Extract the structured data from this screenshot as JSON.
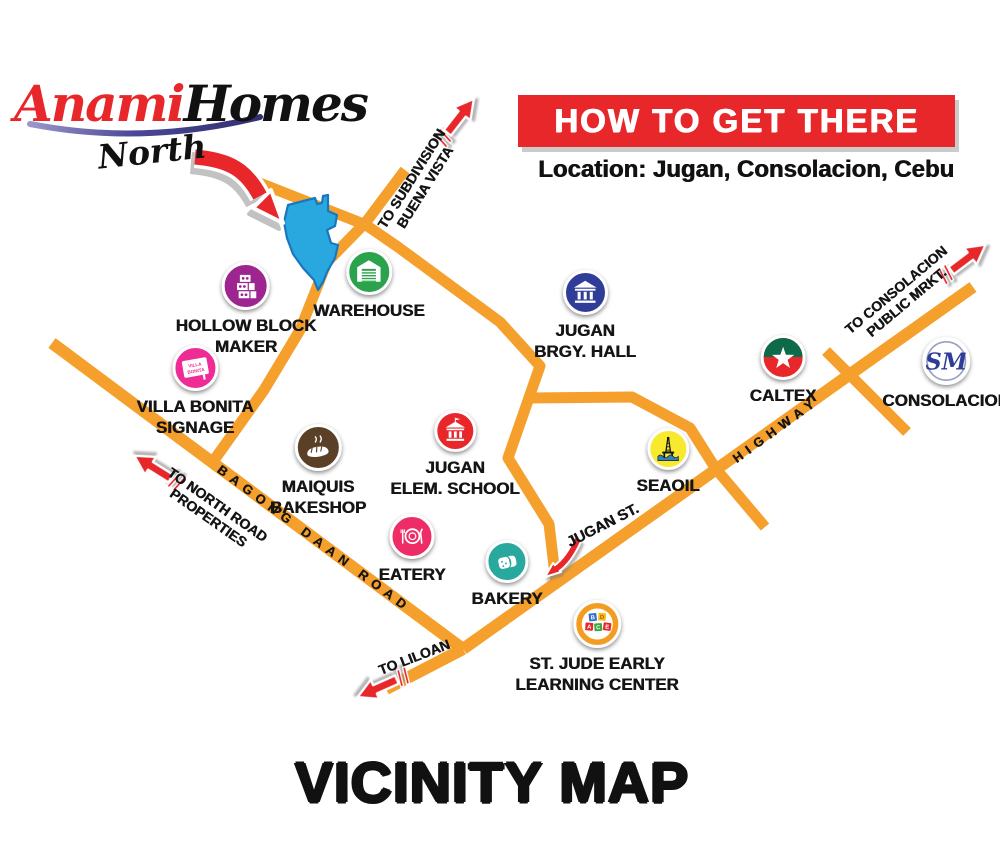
{
  "logo": {
    "brand_red": "Anami",
    "brand_black": "Homes",
    "subtitle": "North"
  },
  "header": {
    "banner": "HOW TO GET THERE",
    "location": "Location: Jugan, Consolacion, Cebu"
  },
  "footer_title": "VICINITY MAP",
  "colors": {
    "road": "#F5A02C",
    "red": "#E8272B",
    "logo_red": "#E8272B",
    "swoosh_purple": "#4B4798",
    "site_blue": "#29A8E0",
    "site_blue_dark": "#1877BE",
    "seaoil_wave": "#2F7FC1",
    "caltex_green": "#0E6B4A",
    "sm_blue": "#2F3D98",
    "block_blue": "#2F6FD0",
    "block_yellow": "#F2C11E",
    "block_red": "#E8272B",
    "block_green": "#3FA545"
  },
  "landmarks": {
    "hollow_block": {
      "line1": "HOLLOW BLOCK",
      "line2": "MAKER",
      "color": "#9E2590"
    },
    "warehouse": {
      "line1": "WAREHOUSE",
      "color": "#2BA24C"
    },
    "villa_bonita": {
      "line1": "VILLA BONITA",
      "line2": "SIGNAGE",
      "color": "#EF2B96",
      "sign_line1": "VILLA",
      "sign_line2": "BONITA"
    },
    "brgy_hall": {
      "line1": "JUGAN",
      "line2": "BRGY. HALL",
      "color": "#2F3D98"
    },
    "elem_school": {
      "line1": "JUGAN",
      "line2": "ELEM. SCHOOL",
      "color": "#E8272B"
    },
    "bakeshop": {
      "line1": "MAIQUIS",
      "line2": "BAKESHOP",
      "color": "#5A4026"
    },
    "eatery": {
      "line1": "EATERY",
      "color": "#EE2D67"
    },
    "bakery": {
      "line1": "BAKERY",
      "color": "#29A99E"
    },
    "seaoil": {
      "line1": "SEAOIL",
      "color": "#F8E92F"
    },
    "caltex": {
      "line1": "CALTEX",
      "color": "#E8272B"
    },
    "sm": {
      "line1": "CONSOLACION",
      "color": "#FFFFFF",
      "logo_text": "SM"
    },
    "st_jude": {
      "line1": "ST. JUDE EARLY",
      "line2": "LEARNING CENTER",
      "color": "#F49C1F",
      "blocks": [
        "B",
        "D",
        "A",
        "C",
        "E"
      ]
    }
  },
  "road_labels": {
    "buena_vista_1": "TO SUBDIVISION",
    "buena_vista_2": "BUENA VISTA",
    "consolacion_1": "TO CONSOLACION",
    "consolacion_2": "PUBLIC MRKT.",
    "highway": "HIGHWAY",
    "jugan_st": "JUGAN ST.",
    "bagong_daan": "BAGONG DAAN ROAD",
    "north_road_1": "TO NORTH ROAD",
    "north_road_2": "PROPERTIES",
    "liloan": "TO LILOAN"
  }
}
